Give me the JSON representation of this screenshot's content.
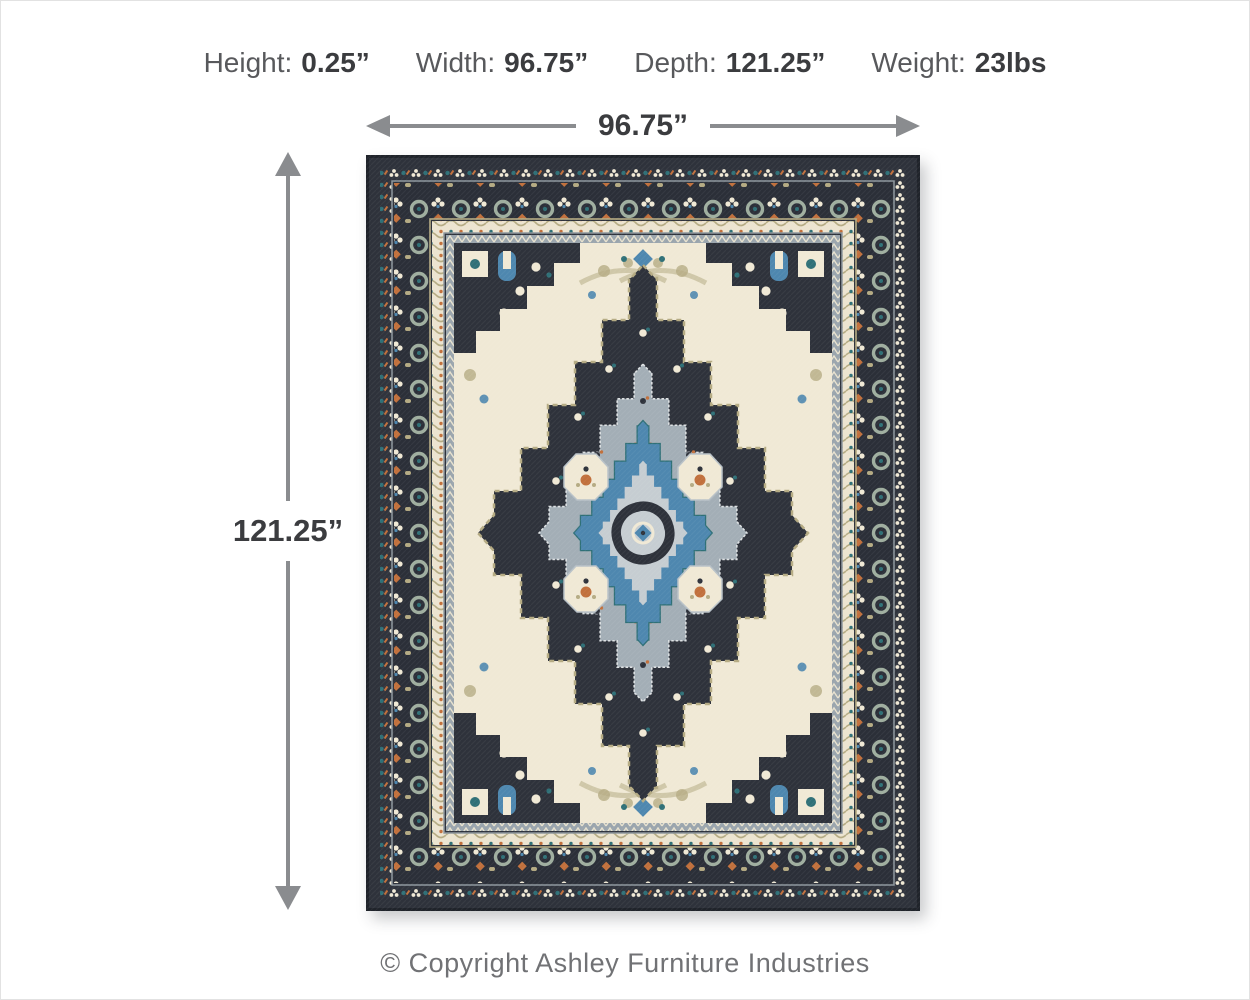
{
  "palette": {
    "arrow_gray": "#8a8c8f",
    "text_dark": "#3b3c3f",
    "rug_navy": "#2e323b",
    "rug_navy_dark": "#1f232a",
    "rug_cream": "#f0e9d5",
    "rug_blue": "#4e87af",
    "rug_light_blue": "#8fb4cd",
    "rug_silver": "#c6cdd2",
    "rug_gray_blue": "#a3aeb6",
    "rug_teal": "#2f7077",
    "rug_sage": "#9fae9f",
    "rug_orange": "#c1703c",
    "rug_tan": "#b5ab83"
  },
  "specs": {
    "items": [
      {
        "label": "Height:",
        "value": "0.25”"
      },
      {
        "label": "Width:",
        "value": "96.75”"
      },
      {
        "label": "Depth:",
        "value": "121.25”"
      },
      {
        "label": "Weight:",
        "value": "23lbs"
      }
    ]
  },
  "width_arrow": {
    "label": "96.75”"
  },
  "height_arrow": {
    "label": "121.25”"
  },
  "footer": {
    "copyright_text": "© Copyright Ashley Furniture Industries"
  }
}
